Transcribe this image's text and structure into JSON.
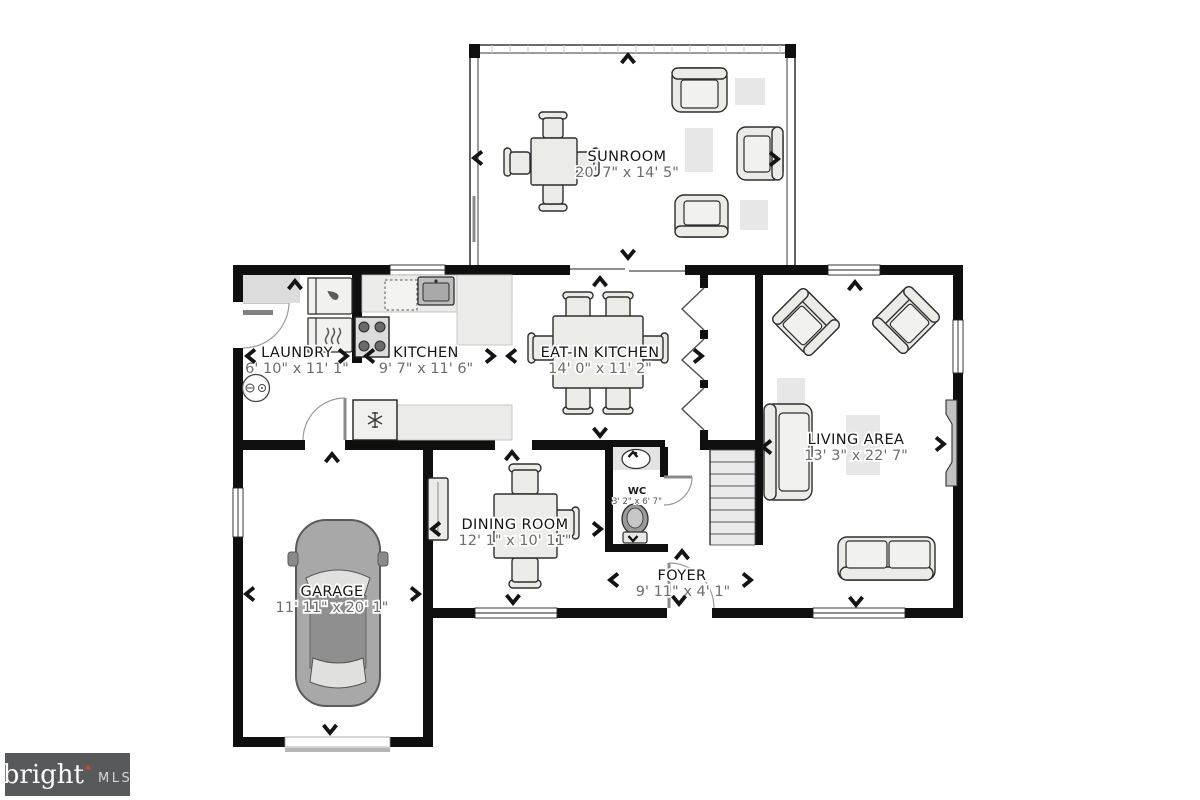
{
  "branding": {
    "brand": "bright",
    "star": "✶",
    "suffix": "MLS"
  },
  "rooms": [
    {
      "name": "SUNROOM",
      "dims": "20' 7\" x 14' 5\""
    },
    {
      "name": "LAUNDRY",
      "dims": "6' 10\" x 11' 1\""
    },
    {
      "name": "KITCHEN",
      "dims": "9' 7\" x 11' 6\""
    },
    {
      "name": "EAT-IN KITCHEN",
      "dims": "14' 0\" x 11' 2\""
    },
    {
      "name": "LIVING AREA",
      "dims": "13' 3\" x 22' 7\""
    },
    {
      "name": "DINING ROOM",
      "dims": "12' 1\" x 10' 11\""
    },
    {
      "name": "WC",
      "dims": "3' 2\" x 6' 7\""
    },
    {
      "name": "FOYER",
      "dims": "9' 11\" x 4' 1\""
    },
    {
      "name": "GARAGE",
      "dims": "11' 11\" x 20' 1\""
    }
  ],
  "colors": {
    "wall": "#0f0f0f",
    "furniture": "#ebebe8",
    "rug": "#e7e7e7",
    "dims_text": "#6d6d6d",
    "logo_bg": "#58595b",
    "logo_star": "#c2502f",
    "car_body": "#a8a8a8"
  }
}
